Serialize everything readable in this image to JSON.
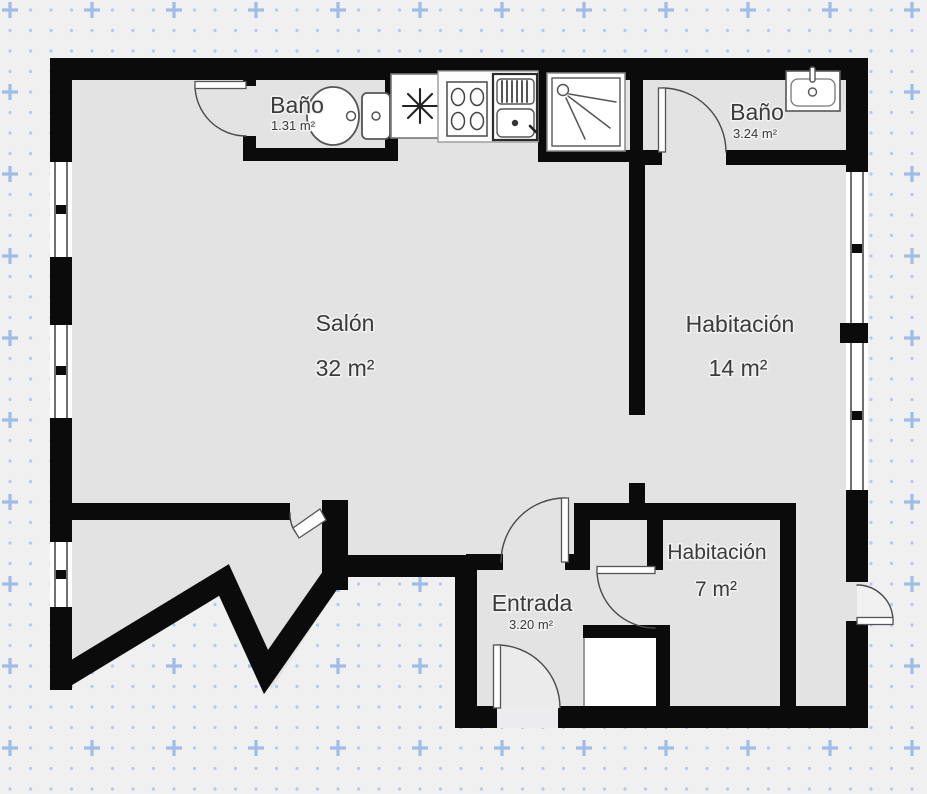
{
  "plan": {
    "title": "apartment-floor-plan",
    "rooms": [
      {
        "id": "bano-1",
        "name": "Baño",
        "area": "1.31 m²"
      },
      {
        "id": "salon",
        "name": "Salón",
        "area": "32 m²"
      },
      {
        "id": "bano-2",
        "name": "Baño",
        "area": "3.24 m²"
      },
      {
        "id": "habitacion-14",
        "name": "Habitación",
        "area": "14 m²"
      },
      {
        "id": "habitacion-7",
        "name": "Habitación",
        "area": "7 m²"
      },
      {
        "id": "entrada",
        "name": "Entrada",
        "area": "3.20 m²"
      }
    ],
    "fixtures": [
      "toilet-icon",
      "refrigerator-snowflake-icon",
      "stove-burners-icon",
      "kitchen-sink-icon",
      "shower-icon",
      "washbasin-icon"
    ],
    "colors": {
      "wall": "#0b0b0b",
      "floor": "#e3e3e4",
      "background": "#f0f0f1",
      "grid_dot": "#b7c9e7",
      "grid_plus": "#9fbde6",
      "label": "#3b3b3b",
      "fixture_outline": "#555555"
    }
  }
}
